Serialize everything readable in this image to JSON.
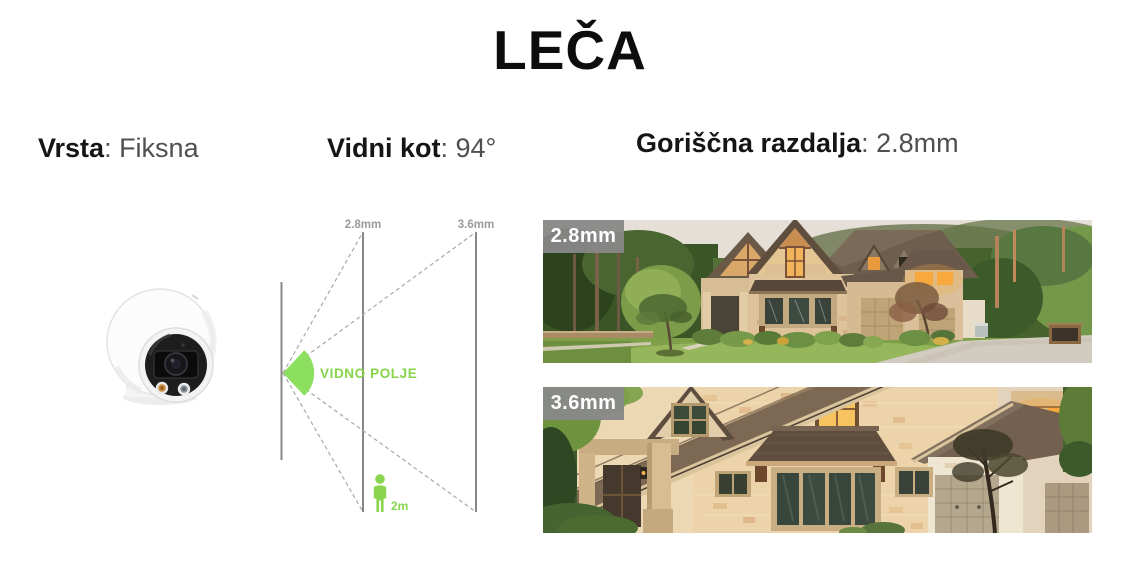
{
  "title": "LEČA",
  "specs": {
    "type": {
      "label": "Vrsta",
      "value": ": Fiksna"
    },
    "angle": {
      "label": "Vidni kot",
      "value": ": 94°"
    },
    "focal": {
      "label": "Goriščna razdalja",
      "value": ": 2.8mm"
    }
  },
  "diagram": {
    "near_line_label": "2.8mm",
    "far_line_label": "3.6mm",
    "fov_label": "VIDNO POLJE",
    "person_height_label": "2m"
  },
  "photos": {
    "wide": {
      "badge": "2.8mm"
    },
    "tele": {
      "badge": "3.6mm"
    }
  },
  "icons": {
    "camera": "turret-camera-illustration",
    "fov_cone": "field-of-view-cone",
    "person": "person-pictogram"
  },
  "colors": {
    "accent_green": "#8ad44f",
    "line_gray": "#878787",
    "dash_gray": "#a8a8a8",
    "badge_gray": "#888888",
    "title_black": "#0d0d0d",
    "value_gray": "#4f4f4f",
    "lit_window_orange": "#f7a93e"
  }
}
